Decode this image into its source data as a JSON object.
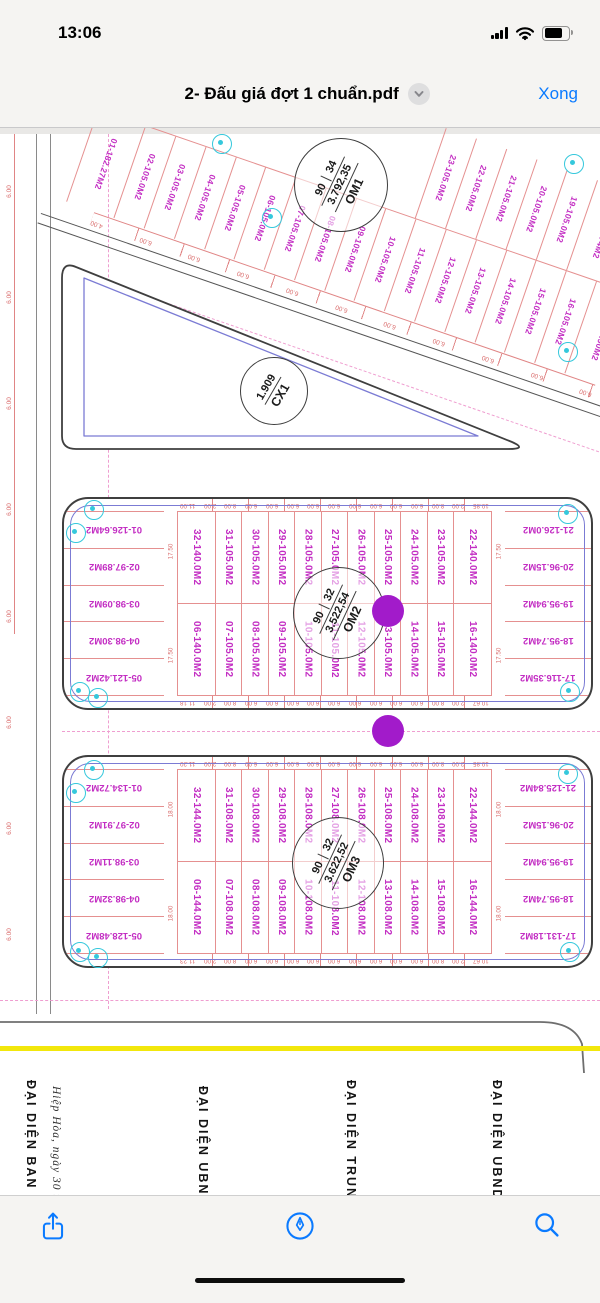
{
  "status_bar": {
    "time": "13:06"
  },
  "nav_bar": {
    "title": "2- Đấu giá đợt 1 chuẩn.pdf",
    "done_label": "Xong"
  },
  "colors": {
    "ios_accent": "#007AFF",
    "plot_label": "#c32ec3",
    "dimension_red": "#d96a6a",
    "survey_cyan": "#35c8dc",
    "annotation_purple": "#a21bca",
    "highlight_yellow": "#f2e70c"
  },
  "map": {
    "om1": {
      "name": "OM1",
      "area": "3.792,35",
      "num1": "90",
      "num2": "34",
      "top_row": [
        "23-105.0M2",
        "22-105.0M2",
        "21-105.0M2",
        "20-105.0M2",
        "19-105.0M2",
        "18-132.74M2"
      ],
      "bottom_row": [
        "01-182.27M2",
        "02-105.0M2",
        "03-105.0M2",
        "04-105.0M2",
        "05-105.0M2",
        "06-105.0M2",
        "07-105.0M2",
        "08-105.0M2",
        "09-105.0M2",
        "10-105.0M2",
        "11-105.0M2",
        "12-105.0M2",
        "13-105.0M2",
        "14-105.0M2",
        "15-105.0M2",
        "16-105.0M2",
        "17-138.90M2"
      ],
      "edge_dims": [
        "4.00",
        "6.00",
        "6.00",
        "6.00",
        "6.00",
        "6.00",
        "6.00",
        "6.00",
        "6.00",
        "6.00",
        "6.00"
      ]
    },
    "cx1": {
      "name": "CX1",
      "area": "1.909"
    },
    "om2": {
      "name": "OM2",
      "area": "3.522,54",
      "num1": "90",
      "num2": "32",
      "left_col": [
        "01-126.64M2",
        "02-97.89M2",
        "03-98.09M2",
        "04-98.30M2",
        "05-121.42M2"
      ],
      "right_col": [
        "21-126.0M2",
        "20-96.15M2",
        "19-95.94M2",
        "18-95.74M2",
        "17-116.35M2"
      ],
      "top_row": [
        "32-140.0M2",
        "31-105.0M2",
        "30-105.0M2",
        "29-105.0M2",
        "28-105.0M2",
        "27-105.0M2",
        "26-105.0M2",
        "25-105.0M2",
        "24-105.0M2",
        "23-105.0M2",
        "22-140.0M2"
      ],
      "bottom_row": [
        "06-140.0M2",
        "07-105.0M2",
        "08-105.0M2",
        "09-105.0M2",
        "10-105.0M2",
        "11-105.0M2",
        "12-105.0M2",
        "13-105.0M2",
        "14-105.0M2",
        "15-105.0M2",
        "16-140.0M2"
      ],
      "top_dims": [
        "11.00",
        "2.00",
        "8.00",
        "6.00",
        "6.00",
        "6.00",
        "6.00",
        "6.00",
        "6.00",
        "6.00",
        "6.00",
        "6.00",
        "8.00",
        "2.00",
        "10.85"
      ],
      "bottom_dims": [
        "11.18",
        "2.00",
        "8.00",
        "6.00",
        "6.00",
        "6.00",
        "6.00",
        "6.00",
        "6.00",
        "6.00",
        "6.00",
        "6.00",
        "8.00",
        "2.00",
        "10.67"
      ],
      "side_dims": [
        "17.50",
        "17.50"
      ],
      "left_edge_dims": [
        "6.50",
        "6.50",
        "6.50"
      ]
    },
    "om3": {
      "name": "OM3",
      "area": "3.622,52",
      "num1": "90",
      "num2": "32",
      "left_col": [
        "01-134.72M2",
        "02-97.91M2",
        "03-98.11M2",
        "04-98.32M2",
        "05-128.48M2"
      ],
      "right_col": [
        "21-125.84M2",
        "20-96.15M2",
        "19-95.94M2",
        "18-95.74M2",
        "17-131.18M2"
      ],
      "top_row": [
        "32-144.0M2",
        "31-108.0M2",
        "30-108.0M2",
        "29-108.0M2",
        "28-108.0M2",
        "27-108.0M2",
        "26-108.0M2",
        "25-108.0M2",
        "24-108.0M2",
        "23-108.0M2",
        "22-144.0M2"
      ],
      "bottom_row": [
        "06-144.0M2",
        "07-108.0M2",
        "08-108.0M2",
        "09-108.0M2",
        "10-108.0M2",
        "11-108.0M2",
        "12-108.0M2",
        "13-108.0M2",
        "14-108.0M2",
        "15-108.0M2",
        "16-144.0M2"
      ],
      "top_dims": [
        "11.20",
        "2.00",
        "8.00",
        "6.00",
        "6.00",
        "6.00",
        "6.00",
        "6.00",
        "6.00",
        "6.00",
        "6.00",
        "6.00",
        "8.00",
        "2.00",
        "10.85"
      ],
      "bottom_dims": [
        "11.23",
        "2.00",
        "8.00",
        "6.00",
        "6.00",
        "6.00",
        "6.00",
        "6.00",
        "6.00",
        "6.00",
        "6.00",
        "6.00",
        "8.00",
        "2.00",
        "10.67"
      ],
      "side_dims": [
        "18.00",
        "18.00"
      ],
      "left_edge_dims": [
        "6.50",
        "6.50",
        "6.50"
      ]
    },
    "road_dims": [
      "6.00",
      "6.00",
      "6.00",
      "6.00",
      "6.00",
      "6.00",
      "6.00",
      "6.00"
    ],
    "signatures": {
      "col1": "ĐẠI DIỆN BAN QLDA",
      "date_note": "Hiệp Hòa, ngày 30 th",
      "col2": "ĐẠI DIỆN UBND X",
      "col3": "ĐẠI DIỆN TRUNG TÂ",
      "col4": "ĐẠI DIỆN UBND HUY"
    }
  }
}
